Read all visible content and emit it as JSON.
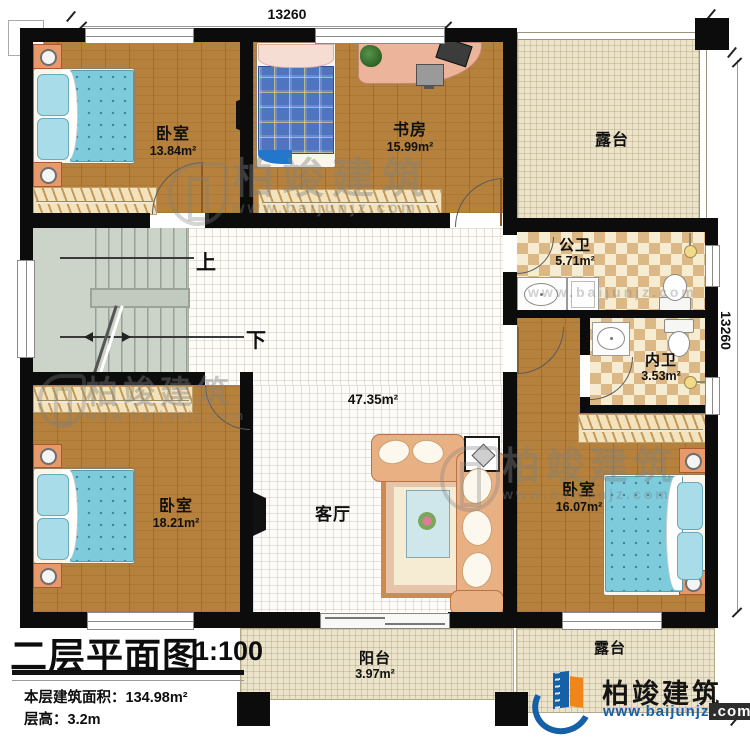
{
  "dims": {
    "top": "13260",
    "right": "13260"
  },
  "rooms": {
    "bedroom_nw": {
      "name": "卧室",
      "area": "13.84m²"
    },
    "study": {
      "name": "书房",
      "area": "15.99m²"
    },
    "terrace_ne": {
      "name": "露台"
    },
    "bath_public": {
      "name": "公卫",
      "area": "5.71m²"
    },
    "bath_private": {
      "name": "内卫",
      "area": "3.53m²"
    },
    "living": {
      "name": "客厅",
      "area": "47.35m²"
    },
    "bedroom_sw": {
      "name": "卧室",
      "area": "18.21m²"
    },
    "bedroom_se": {
      "name": "卧室",
      "area": "16.07m²"
    },
    "balcony": {
      "name": "阳台",
      "area": "3.97m²"
    },
    "terrace_se": {
      "name": "露台"
    }
  },
  "stairs": {
    "up_label": "上",
    "down_label": "下"
  },
  "title_block": {
    "title": "二层平面图",
    "scale": "1:100",
    "area_label": "本层建筑面积：",
    "area_value": "134.98m²",
    "height_label": "层高：",
    "height_value": "3.2m"
  },
  "branding": {
    "company": "柏竣建筑",
    "website_main": "www.baijunjz",
    "website_suffix": ".com"
  },
  "watermarks": {
    "company": "柏竣建筑",
    "url": "www.baijunjz.com"
  },
  "colors": {
    "wall": "#0c0c0c",
    "wood_floor": "#b5813c",
    "tile_tan": "#dcb886",
    "tile_cream": "#f6ecd2",
    "terrace_beige": "#ece4ca",
    "living_white": "#fdfcf8",
    "stairs_green": "#ccd3c8",
    "bed_blue": "#7ecbdc",
    "plaid_blue": "#4f74c0",
    "furniture_orange": "#e8996a",
    "sofa_tan": "#e9b183",
    "logo_blue": "#1660a8",
    "logo_orange": "#f08519"
  }
}
